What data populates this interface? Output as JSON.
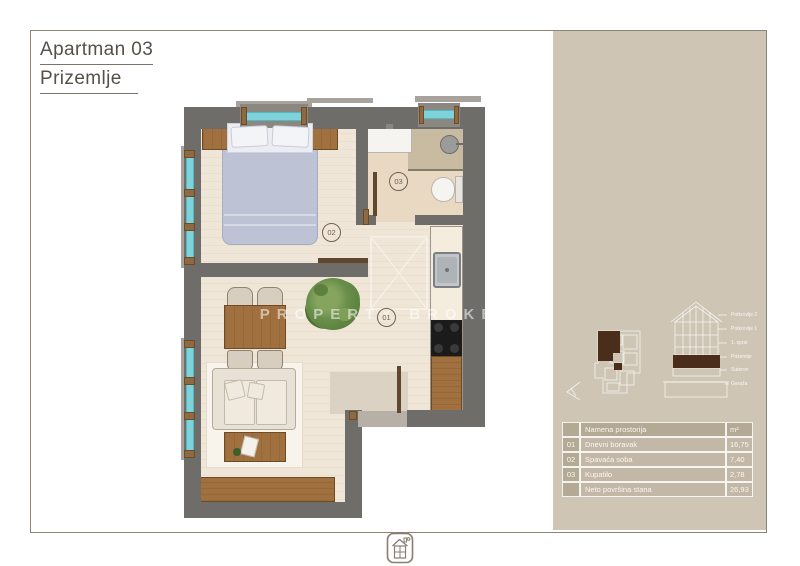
{
  "page": {
    "title_line1": "Apartman 03",
    "title_line2": "Prizemlje"
  },
  "plan": {
    "watermark": "PROPERTY BROKER",
    "room_labels": [
      {
        "id": "01"
      },
      {
        "id": "02"
      },
      {
        "id": "03"
      }
    ]
  },
  "sidebar": {
    "section_diagram": {
      "floor_labels": [
        "Potkrovlje 2",
        "Potkrovlje 1",
        "1. sprat",
        "Prizemlje",
        "Suteren",
        "Garaža"
      ]
    },
    "table": {
      "header": {
        "num": "",
        "name": "Namena prostorija",
        "area": "m²"
      },
      "rows": [
        {
          "num": "01",
          "name": "Dnevni boravak",
          "area": "16,75"
        },
        {
          "num": "02",
          "name": "Spavaća soba",
          "area": "7,40"
        },
        {
          "num": "03",
          "name": "Kupatilo",
          "area": "2,78"
        }
      ],
      "footer": {
        "num": "",
        "name": "Neto površina stana",
        "area": "26,93"
      }
    }
  },
  "colors": {
    "sidebar_bg": "#cfc5b5",
    "wall": "#6f6d6a",
    "floor": "#f0e6d7",
    "bath_floor": "#ead9c2",
    "window_glass": "#7ed3da",
    "wood": "#a0713f",
    "unit_highlight": "#4a2e1b",
    "title_text": "#56504a",
    "table_text": "#faf7f1"
  }
}
